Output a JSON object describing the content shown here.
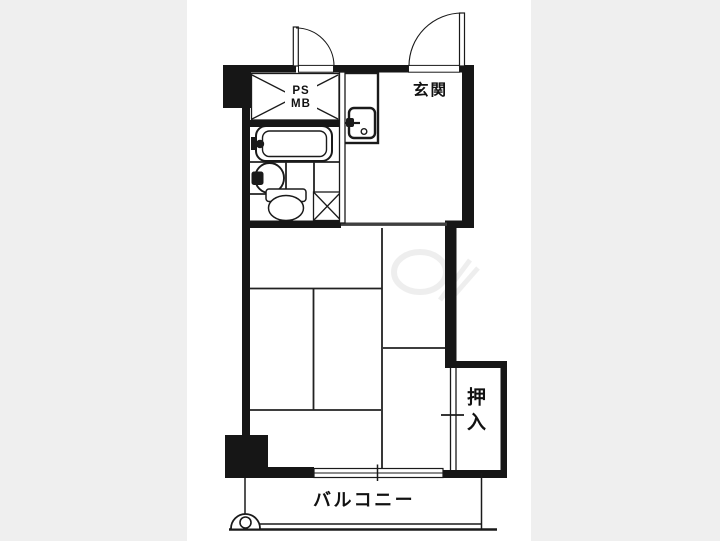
{
  "page": {
    "type": "floor-plan-image",
    "background_color": "#efefef",
    "photo_background_color": "#ffffff",
    "ink_color": "#1a1a1a"
  },
  "floor_plan": {
    "labels": {
      "entrance": "玄関",
      "pipe_space": "PS",
      "meter_box": "MB",
      "closet": "押入",
      "balcony": "バルコニー"
    },
    "fixtures": [
      "entrance-door-swing",
      "utility-door-swing",
      "pipe-space-meter-box-cross",
      "bathtub",
      "washbasin",
      "toilet",
      "washer-space-cross",
      "entrance-sink-unit",
      "closet-sliding-door",
      "balcony-sliding-window",
      "balcony-railing",
      "balcony-drain"
    ]
  }
}
